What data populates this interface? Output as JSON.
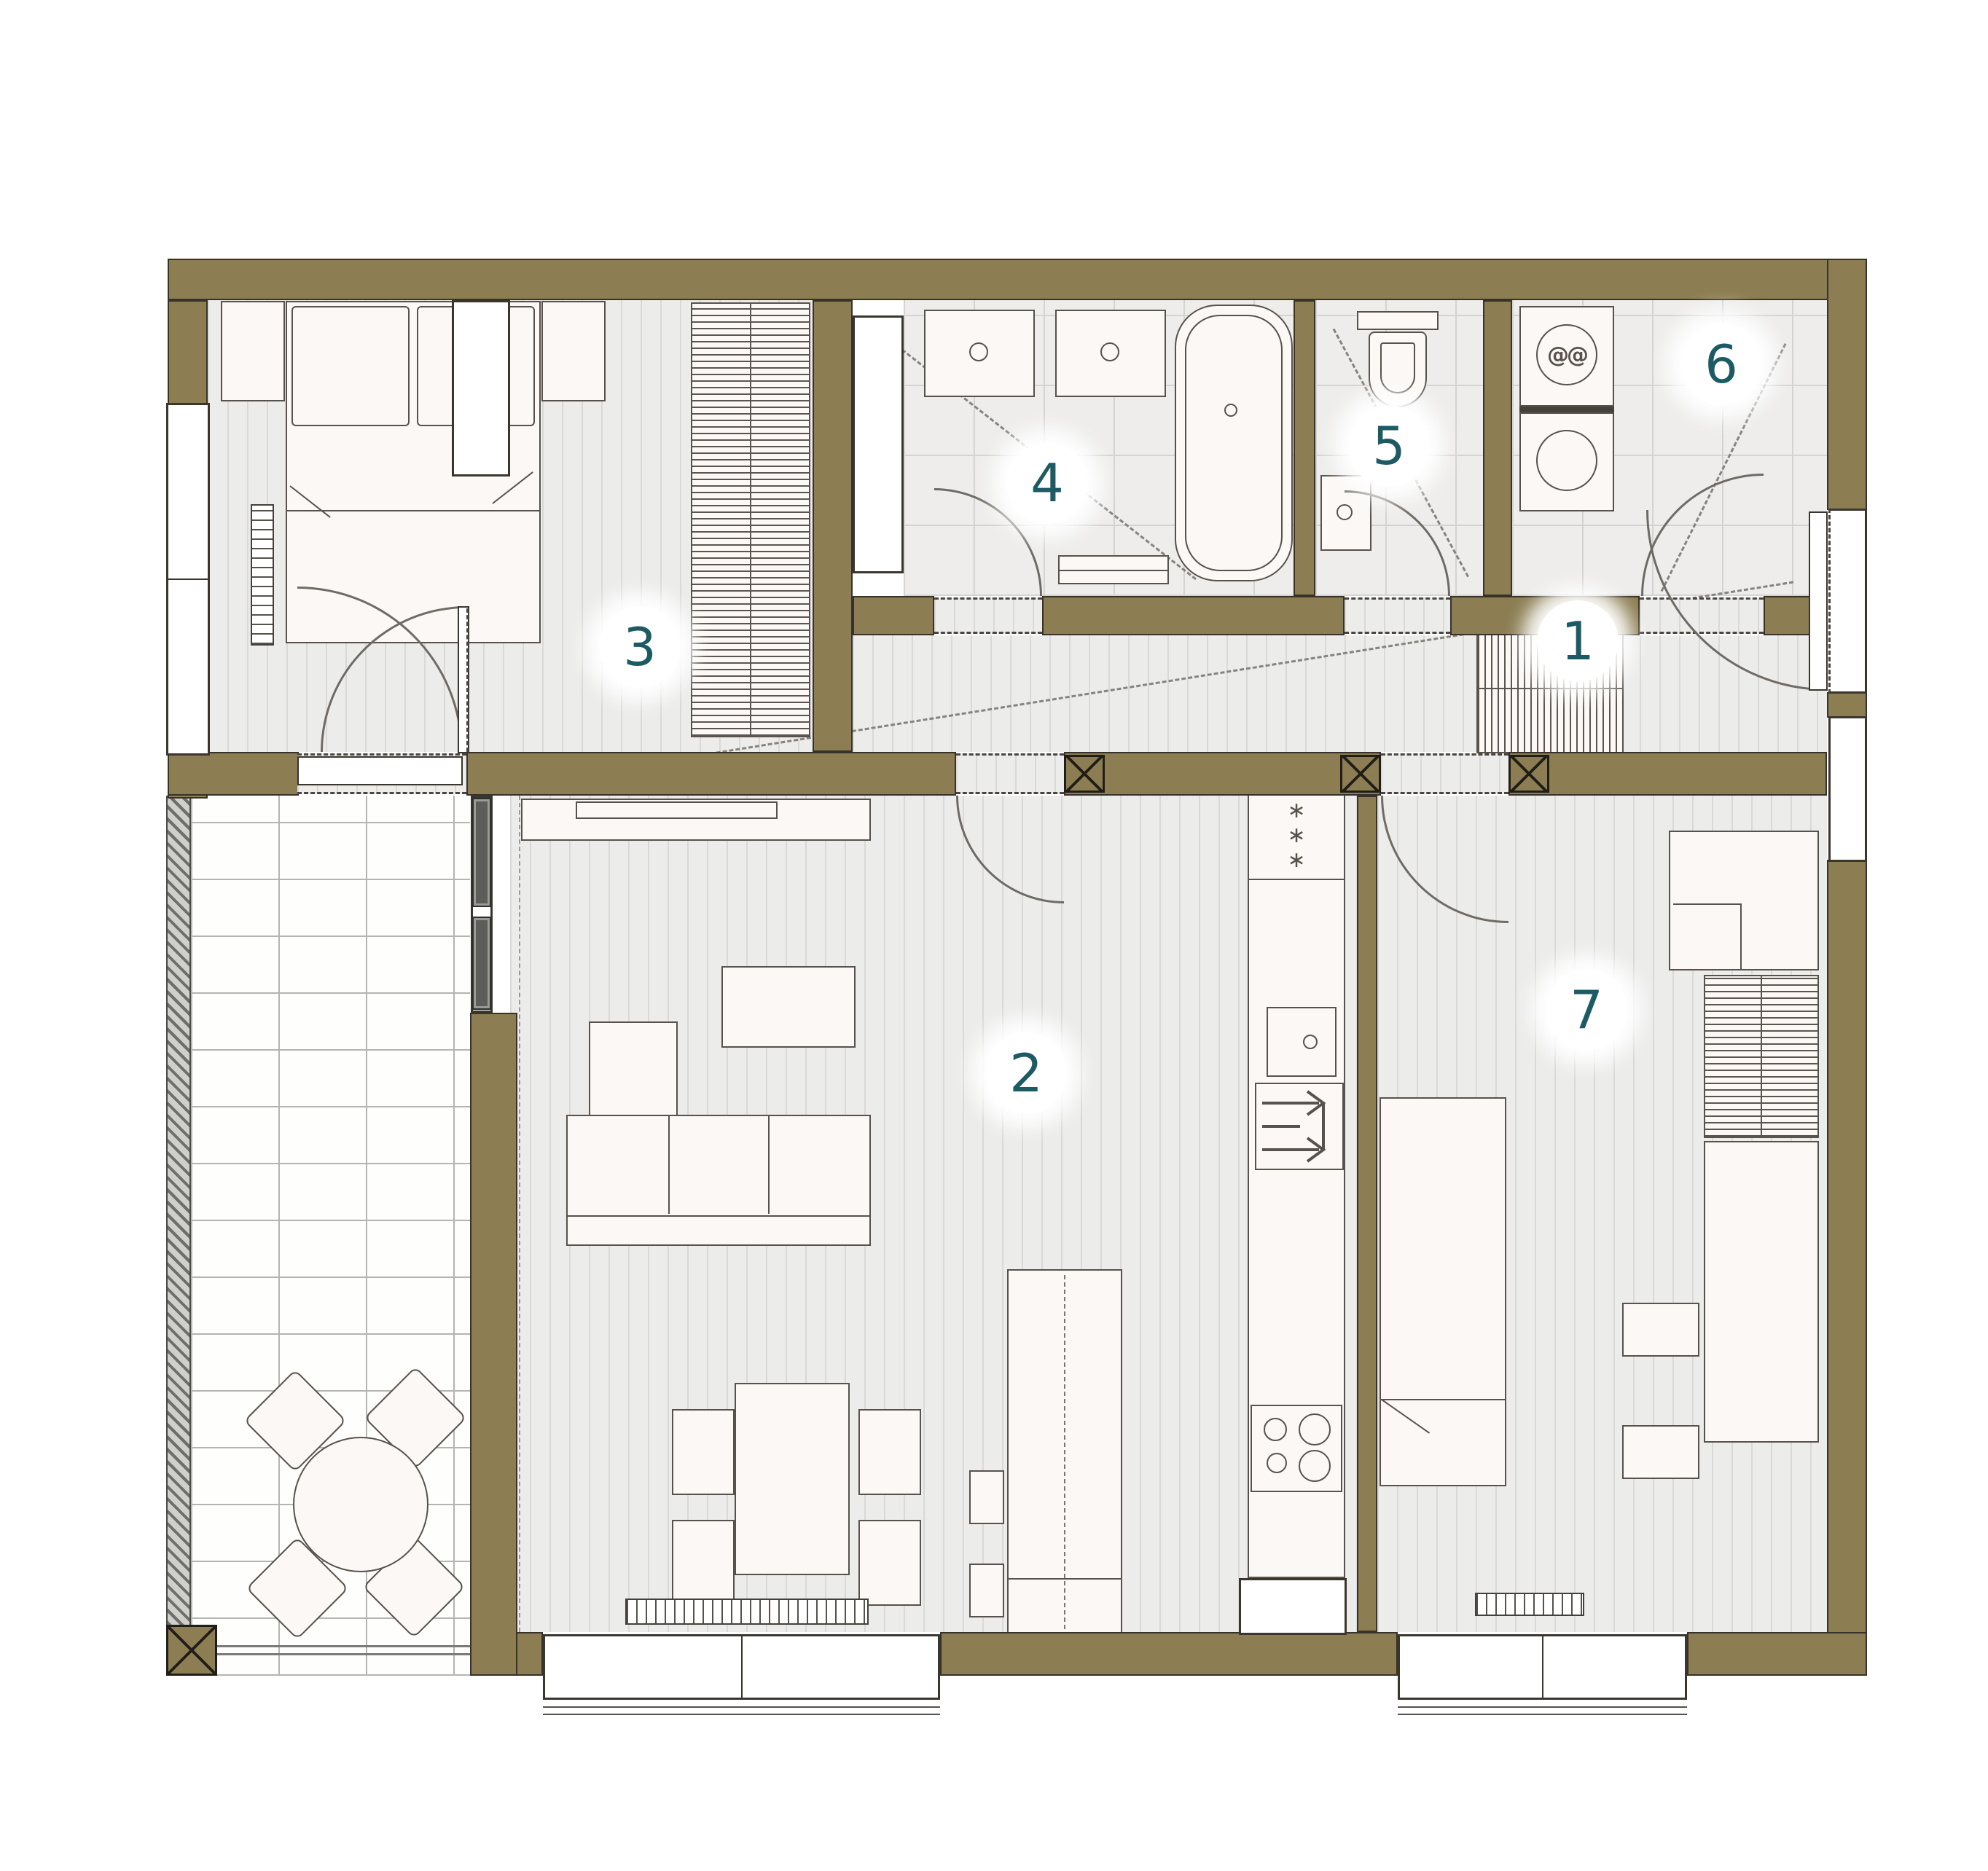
{
  "plan": {
    "type": "apartment-floor-plan",
    "colors": {
      "wall": "#8c7d52",
      "wall_outline": "#37322a",
      "floor_bg": "#ececeb",
      "floor_line": "#d9d9d7",
      "tile_bg": "#eeedec",
      "tile_line": "#d3d3d1",
      "terrace_bg": "#fefefd",
      "terrace_line": "#b4b4b1",
      "furniture_fill": "#fbf8f5",
      "furniture_stroke": "#57524b",
      "glass_panel": "#5d5d5a",
      "door_arc": "#6f6b64",
      "sight_line": "#85837d",
      "badge_bg": "#ffffff",
      "badge_text": "#1d5b64"
    },
    "rooms": [
      {
        "number": "1"
      },
      {
        "number": "2"
      },
      {
        "number": "3"
      },
      {
        "number": "4"
      },
      {
        "number": "5"
      },
      {
        "number": "6"
      },
      {
        "number": "7"
      }
    ],
    "icons": {
      "freezer_stars": "∗\n∗\n∗",
      "washer_drum": "@@"
    }
  }
}
